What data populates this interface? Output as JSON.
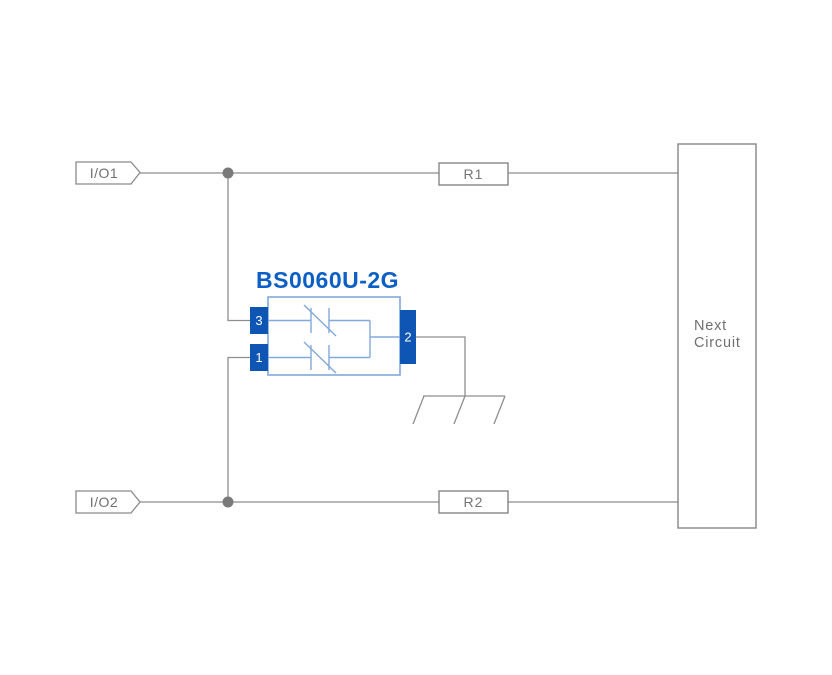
{
  "diagram": {
    "title": "BS0060U-2G",
    "labels": {
      "io1": "I/O1",
      "io2": "I/O2",
      "r1": "R1",
      "r2": "R2",
      "next_line1": "Next",
      "next_line2": "Circuit"
    },
    "pins": {
      "pin3": "3",
      "pin1": "1",
      "pin2": "2"
    },
    "colors": {
      "accent_blue": "#0f55b4",
      "title_blue": "#0c5fc4",
      "component_border_blue": "#82a9db",
      "wire_gray": "#8e8e8e",
      "text_gray": "#6f6f6f",
      "background": "#ffffff"
    }
  }
}
